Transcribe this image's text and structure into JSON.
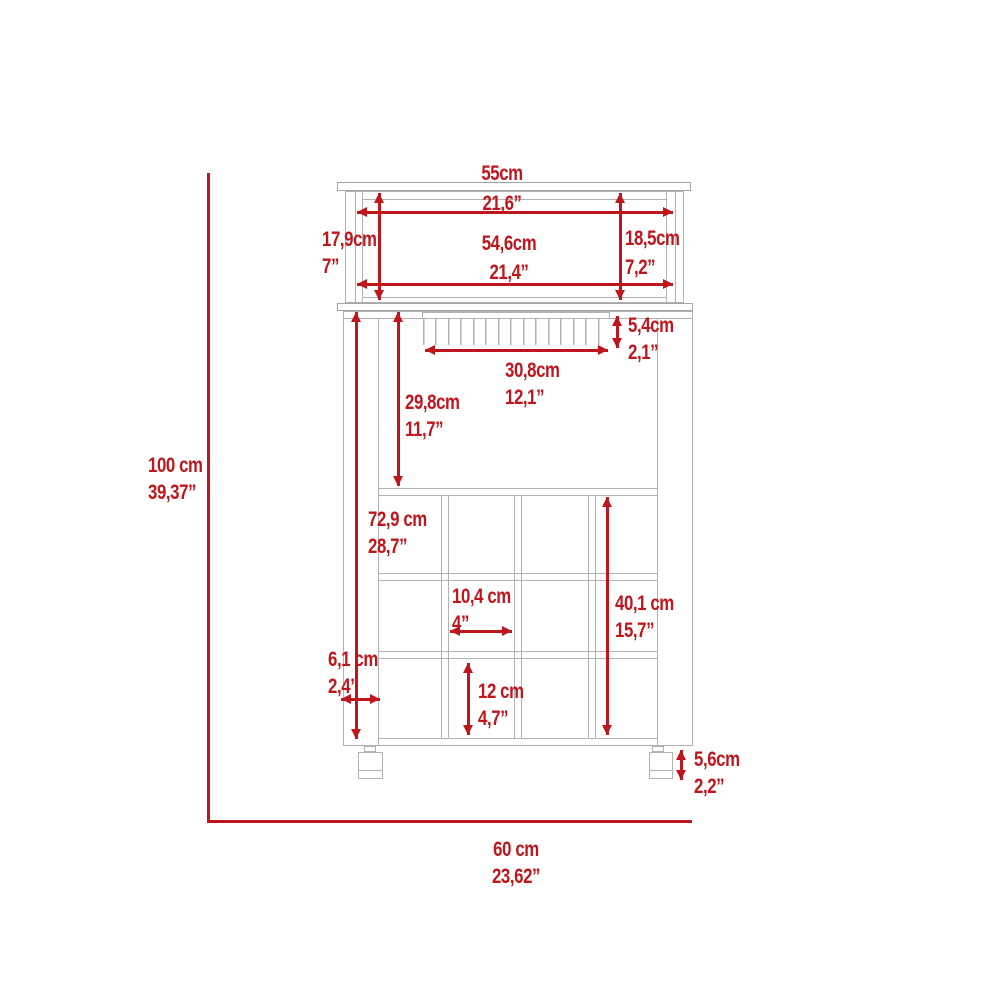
{
  "diagram": {
    "subject": "bar-cart-dimension-drawing",
    "colors": {
      "dimension_red": "#bf161d",
      "outline_gray": "#b2b2b2"
    },
    "overall": {
      "height": {
        "cm": "100 cm",
        "in": "39,37”"
      },
      "width": {
        "cm": "60 cm",
        "in": "23,62”"
      }
    },
    "dims": {
      "top_width": {
        "cm": "55cm",
        "in": "21,6”"
      },
      "top_surface_width": {
        "cm": "54,6cm",
        "in": "21,4”"
      },
      "hutch_left_height": {
        "cm": "17,9cm",
        "in": "7”"
      },
      "hutch_right_height": {
        "cm": "18,5cm",
        "in": "7,2”"
      },
      "glass_rack_height": {
        "cm": "5,4cm",
        "in": "2,1”"
      },
      "glass_rack_width": {
        "cm": "30,8cm",
        "in": "12,1”"
      },
      "open_shelf_height": {
        "cm": "29,8cm",
        "in": "11,7”"
      },
      "cabinet_height": {
        "cm": "72,9 cm",
        "in": "28,7”"
      },
      "wine_rack_height": {
        "cm": "40,1 cm",
        "in": "15,7”"
      },
      "cubby_width": {
        "cm": "10,4 cm",
        "in": "4”"
      },
      "cubby_height": {
        "cm": "12 cm",
        "in": "4,7”"
      },
      "side_panel_width": {
        "cm": "6,1 cm",
        "in": "2,4”"
      },
      "caster_height": {
        "cm": "5,6cm",
        "in": "2,2”"
      }
    }
  }
}
